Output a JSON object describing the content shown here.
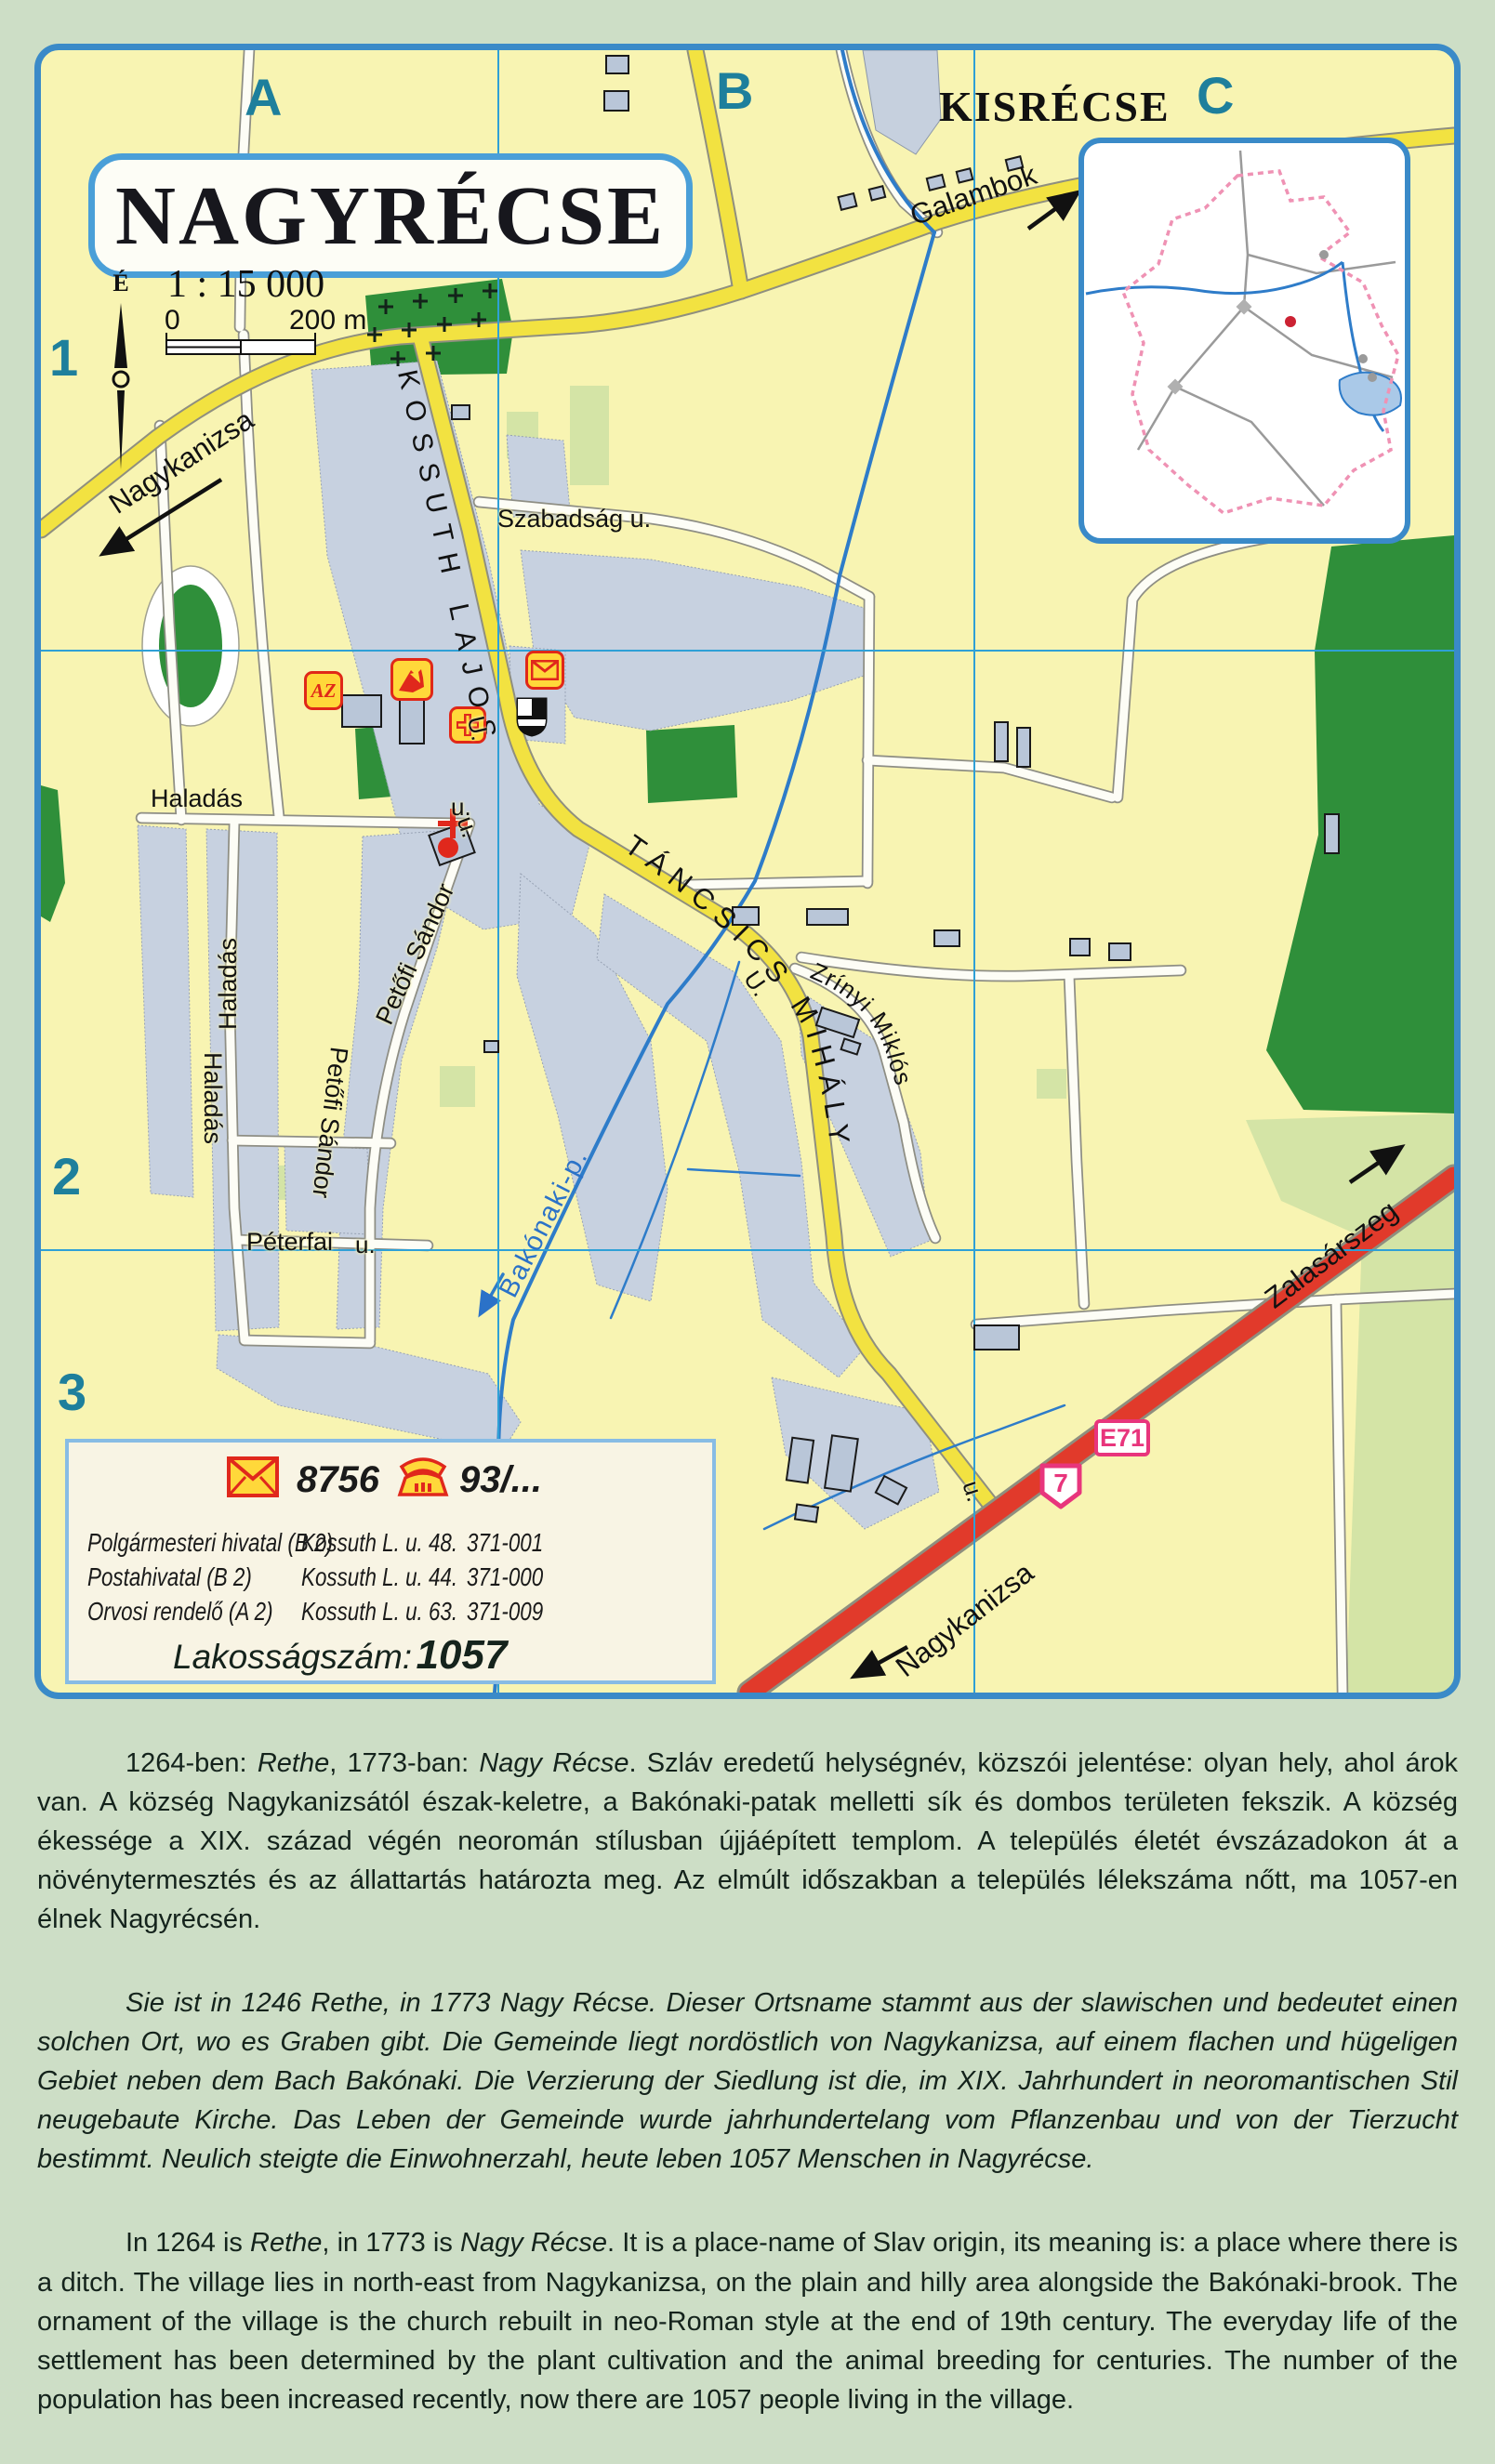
{
  "map": {
    "title": "NAGYRÉCSE",
    "scale_text": "1 : 15 000",
    "scale_bar_start": "0",
    "scale_bar_end": "200 m",
    "north_label": "É",
    "grid_columns": [
      "A",
      "B",
      "C"
    ],
    "grid_rows": [
      "1",
      "2",
      "3"
    ],
    "neighbor_settlement": "KISRÉCSE",
    "signs": {
      "euro_route": "E71",
      "national_route": "7"
    },
    "directions": {
      "northwest": "Nagykanizsa",
      "northeast": "Galambok",
      "east": "Zalasárszeg",
      "south": "Nagykanizsa"
    },
    "streets": {
      "kossuth": "KOSSUTH LAJOS",
      "tancsics": "TÁNCSICS MIHÁLY",
      "szabadsag": "Szabadság u.",
      "haladas": "Haladás",
      "petofi": "Petőfi Sándor",
      "peterfai": "Péterfai",
      "zrinyi": "Zrínyi Miklós",
      "u_abbrev": "u.",
      "u_abbrev_cap": "U."
    },
    "stream_label": "Bakónaki-p.",
    "icons": {
      "az": "AZ"
    }
  },
  "legend": {
    "postal_code": "8756",
    "phone_prefix": "93/...",
    "entries": [
      {
        "name": "Polgármesteri hivatal (B 2)",
        "address": "Kossuth L. u. 48.",
        "phone": "371-001"
      },
      {
        "name": "Postahivatal (B 2)",
        "address": "Kossuth L. u. 44.",
        "phone": "371-000"
      },
      {
        "name": "Orvosi rendelő (A 2)",
        "address": "Kossuth L. u. 63.",
        "phone": "371-009"
      }
    ],
    "population_label": "Lakosságszám:",
    "population_value": "1057"
  },
  "paragraphs": {
    "hu_parts": [
      "1264-ben: ",
      "Rethe",
      ", 1773-ban: ",
      "Nagy Récse",
      ". Szláv eredetű helységnév, közszói jelentése: olyan hely, ahol árok van. A község Nagykanizsától észak-keletre, a Bakónaki-patak melletti sík és dombos területen fekszik. A község ékessége a XIX. század végén neoromán stílusban újjáépített templom. A település életét évszázadokon át a növénytermesztés és az állattartás határozta meg. Az elmúlt időszakban a település lélekszáma nőtt, ma 1057-en élnek Nagyrécsén."
    ],
    "de": "Sie ist in 1246 Rethe, in 1773 Nagy Récse. Dieser Ortsname stammt aus der slawischen und bedeutet einen solchen Ort, wo es Graben gibt. Die Gemeinde liegt nordöstlich von Nagykanizsa, auf einem flachen und hügeligen Gebiet neben dem Bach Bakónaki. Die Verzierung der Siedlung ist die, im XIX. Jahrhundert in neoromantischen Stil neugebaute Kirche. Das Leben der Gemeinde wurde jahrhundertelang vom Pflanzenbau und von der Tierzucht bestimmt. Neulich steigte die Einwohnerzahl, heute leben 1057 Menschen in Nagyrécse.",
    "en_parts": [
      "In 1264 is ",
      "Rethe",
      ", in 1773 is ",
      "Nagy Récse",
      ". It is a place-name of Slav origin, its meaning is: a place where there is a ditch. The village lies in north-east from Nagykanizsa, on the plain and hilly area alongside the Bakónaki-brook. The ornament of the village is the church rebuilt in neo-Roman style at the end of 19th century. The everyday life of the settlement has been determined by the plant cultivation and the animal breeding for centuries. The number of the population has been increased recently, now there are 1057 people living in the village."
    ]
  },
  "colors": {
    "frame_blue": "#3a8ac8",
    "map_yellow": "#f8f4b2",
    "road_yellow": "#f2e241",
    "highway_red": "#e13a2b",
    "grid_blue": "#2fa0d6",
    "label_teal": "#1e7f9c",
    "sign_pink": "#e8357c",
    "forest_green": "#2f8f3a",
    "field_green": "#cfe2a0",
    "builtup_gray": "#c7d1e0",
    "water_blue": "#2e7cc9",
    "legend_bg": "#f8f4e4",
    "icon_yellow": "#ffd83a",
    "icon_red": "#e02818"
  }
}
